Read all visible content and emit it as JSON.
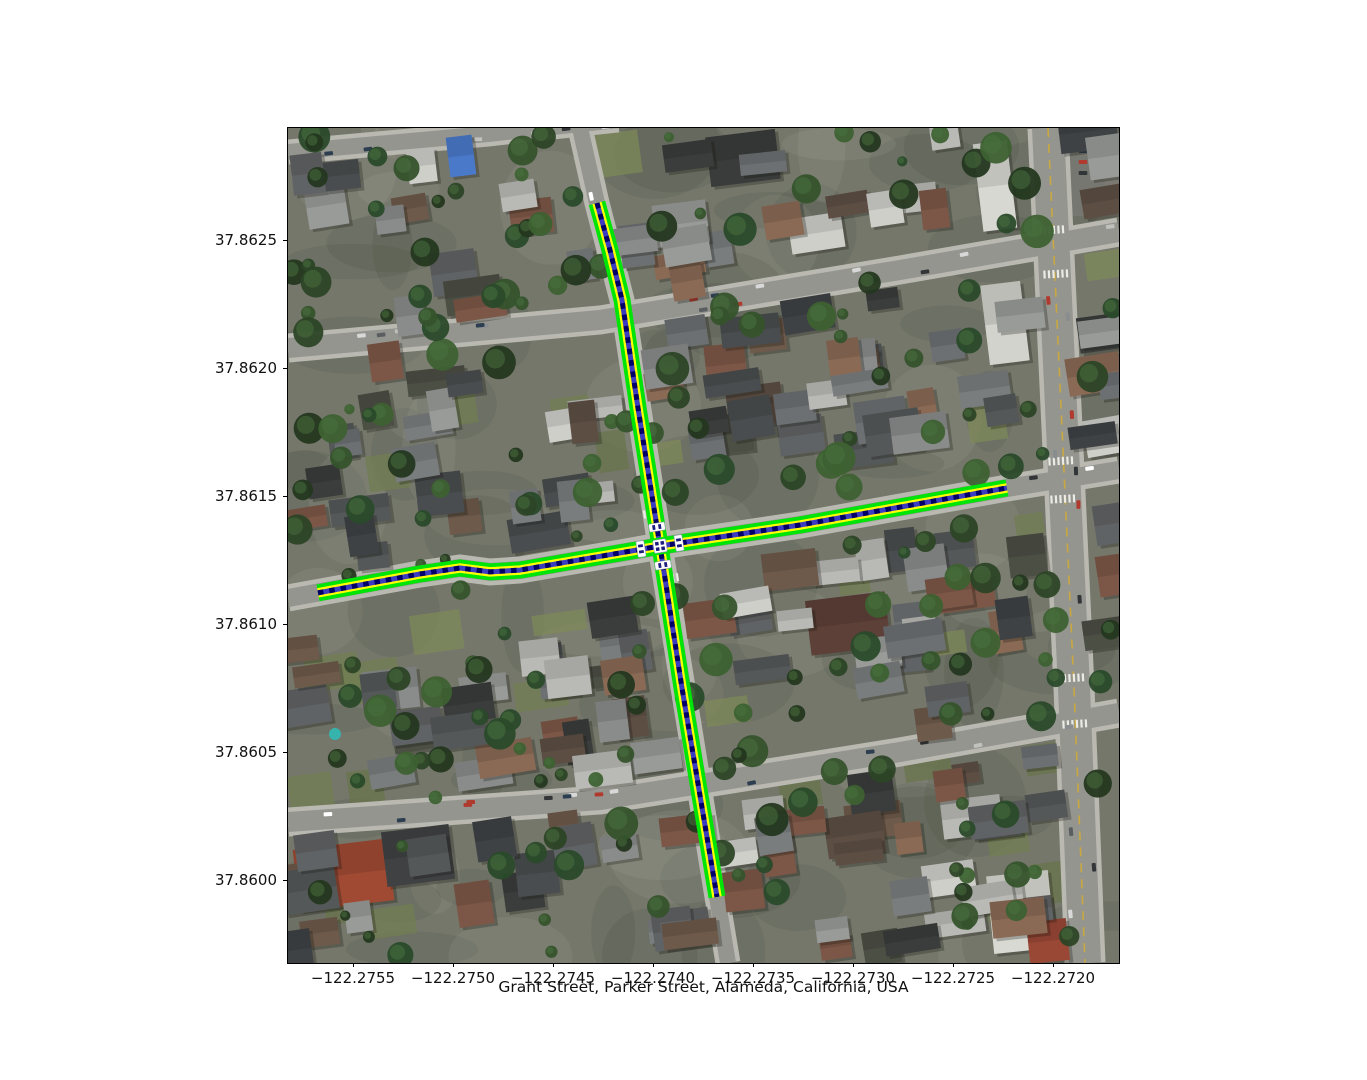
{
  "figure": {
    "xlabel": "Grant Street, Parker Street, Alameda, California, USA",
    "x_tick_labels": [
      "−122.2755",
      "−122.2750",
      "−122.2745",
      "−122.2740",
      "−122.2735",
      "−122.2730",
      "−122.2725",
      "−122.2720"
    ],
    "y_tick_labels": [
      "37.8625",
      "37.8620",
      "37.8615",
      "37.8610",
      "37.8605",
      "37.8600"
    ],
    "x_range": [
      -122.275825,
      -122.27167
    ],
    "y_range": [
      37.859676,
      37.862938
    ]
  },
  "map": {
    "place": "Alameda, California, USA",
    "highlighted_streets": [
      "Grant Street",
      "Parker Street"
    ],
    "imagery": "aerial-photo-residential-neighborhood",
    "route_style": {
      "outline_color": "#00e408",
      "inner_color": "#ffff00",
      "centerline_color": "#000066",
      "centerline_dash_color": "#3c3cc0",
      "marker_color": "#ffffff",
      "marker_stripe_color": "#1d1d7d"
    },
    "routes": [
      {
        "id": "north-south-street",
        "points_lonlat": [
          [
            -122.27428,
            37.862645
          ],
          [
            -122.274215,
            37.862461
          ],
          [
            -122.274155,
            37.862266
          ],
          [
            -122.274075,
            37.861844
          ],
          [
            -122.273965,
            37.861305
          ],
          [
            -122.273855,
            37.86075
          ],
          [
            -122.27368,
            37.859934
          ]
        ]
      },
      {
        "id": "east-west-street",
        "points_lonlat": [
          [
            -122.275675,
            37.861122
          ],
          [
            -122.275165,
            37.861196
          ],
          [
            -122.274965,
            37.861219
          ],
          [
            -122.274815,
            37.861204
          ],
          [
            -122.274665,
            37.861211
          ],
          [
            -122.274165,
            37.861278
          ],
          [
            -122.273965,
            37.861305
          ],
          [
            -122.273265,
            37.861387
          ],
          [
            -122.27223,
            37.861532
          ]
        ]
      }
    ],
    "intersection_lonlat": [
      -122.273965,
      37.861305
    ]
  }
}
